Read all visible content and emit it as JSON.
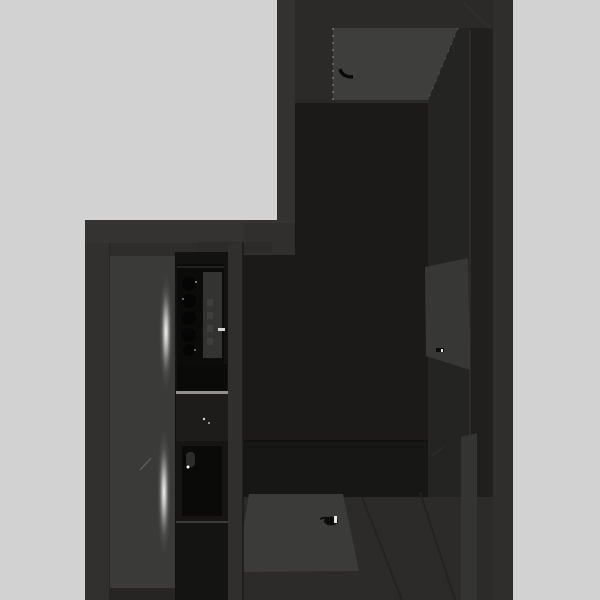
{
  "scene": {
    "description": "Top-down 3D render of an L-shaped apartment interior",
    "objects": [
      "entry-door-open-top",
      "entry-door-handle",
      "side-door-open-right",
      "side-door-handle",
      "kitchen-cooktop",
      "kitchen-sink",
      "kitchen-counter",
      "kitchen-shelf",
      "divider-wall",
      "floor-rug",
      "rug-decor-item",
      "floor-light-flare",
      "wall-light-strip"
    ]
  },
  "colors": {
    "background": "#d2d2d2",
    "wall_base": "#2b2a28",
    "wall_top_band": "#343331",
    "wall_corner": "#302f2d",
    "wall_left_face": "#31302e",
    "wall_top_left": "#333230",
    "wall_outer_right": "#2f2e2c",
    "cabinet_column": "#242422",
    "cabinet_inner": "#201f1d",
    "floor_main": "#1b1a18",
    "floor_band": "#171715",
    "floor_corridor": "#2c2b29",
    "floor_left": "#3a3a38",
    "floor_left_shadow": "#2e2d2b",
    "floor_left_bottom": "#262523",
    "divider_wall": "#312f2d",
    "door_top": "#3e3e3c",
    "door_side": "#373735",
    "light_strip": "#343432",
    "rug": "#3b3b39",
    "kitchen_strip": "#121210",
    "cooktop": "#0b0b09",
    "cooktop_panel": "#333331",
    "burner": "#050505",
    "knob": "#3e3e3c",
    "gap_dark": "#0a0a08",
    "counter": "#1d1c1a",
    "counter_edge": "#90908e",
    "sink": "#161514",
    "basin": "#0a0a09",
    "faucet": "#2c2c2a",
    "shelf": "#2c2b29",
    "below_sink": "#141412",
    "item_dark": "#0d0d0b",
    "sparkle": "#ffffff",
    "dash_bright": "#d8d8d6",
    "handle_dark": "#0a0a0a"
  }
}
